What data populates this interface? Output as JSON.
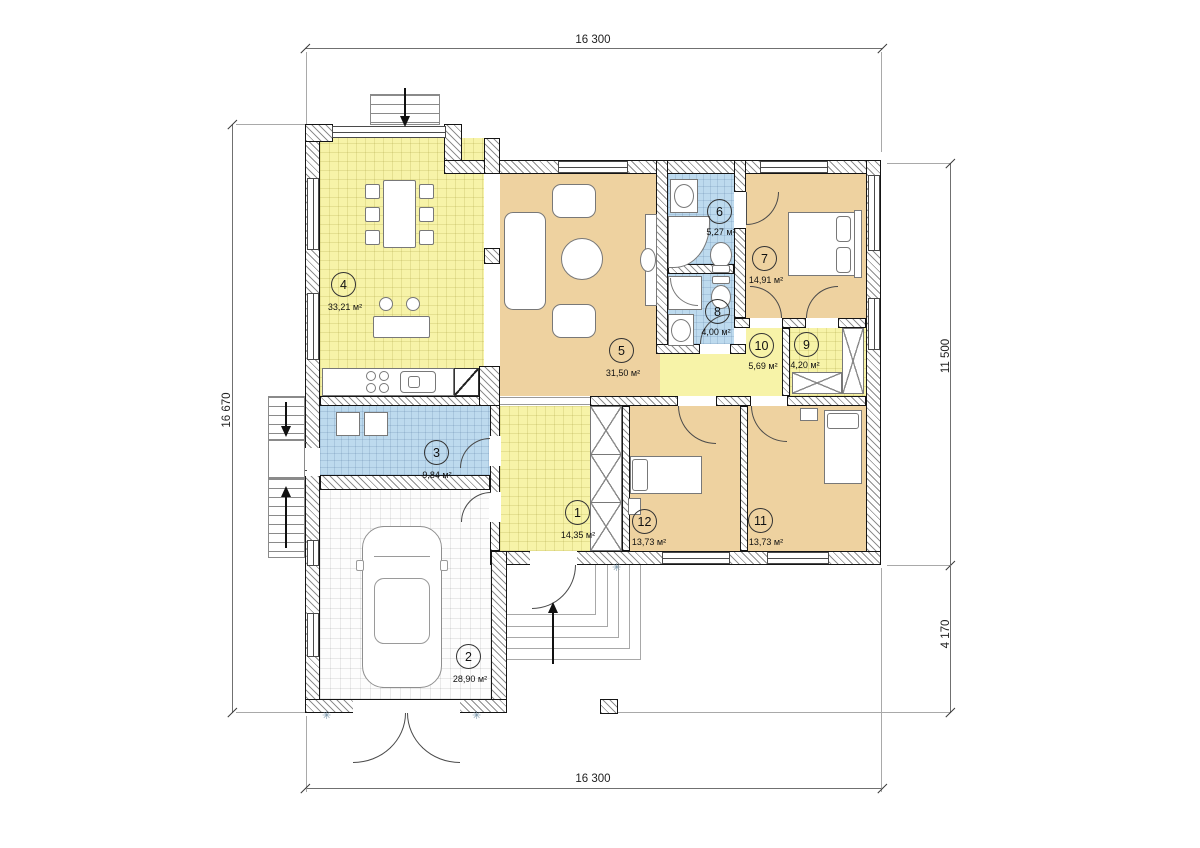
{
  "dimensions": {
    "top": "16 300",
    "bottom": "16 300",
    "left": "16 670",
    "right_upper": "11 500",
    "right_lower": "4 170"
  },
  "rooms": [
    {
      "number": "1",
      "area": "14,35 м²"
    },
    {
      "number": "2",
      "area": "28,90 м²"
    },
    {
      "number": "3",
      "area": "9,84 м²"
    },
    {
      "number": "4",
      "area": "33,21 м²"
    },
    {
      "number": "5",
      "area": "31,50 м²"
    },
    {
      "number": "6",
      "area": "5,27 м²"
    },
    {
      "number": "7",
      "area": "14,91 м²"
    },
    {
      "number": "8",
      "area": "4,00 м²"
    },
    {
      "number": "9",
      "area": "4,20 м²"
    },
    {
      "number": "10",
      "area": "5,69 м²"
    },
    {
      "number": "11",
      "area": "13,73 м²"
    },
    {
      "number": "12",
      "area": "13,73 м²"
    }
  ],
  "icons": {
    "drain_marker": "✳"
  }
}
